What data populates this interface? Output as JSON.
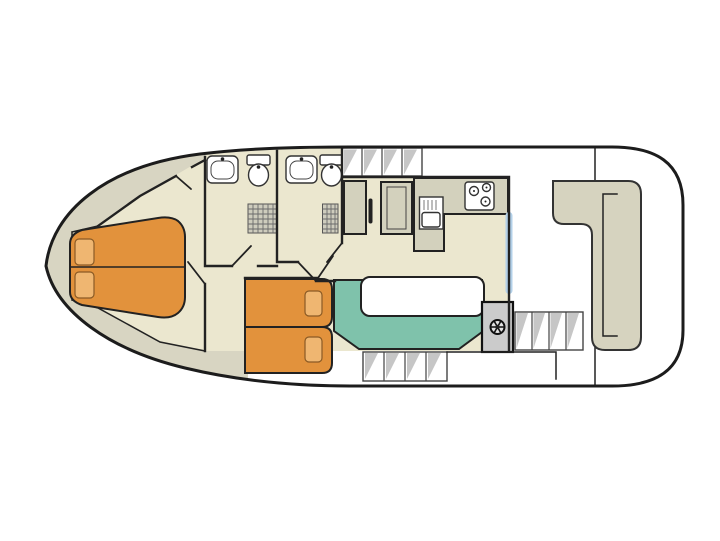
{
  "diagram": {
    "kind": "houseboat-deck-plan",
    "rooms": [
      {
        "name": "foredeck"
      },
      {
        "name": "bow-cabin"
      },
      {
        "name": "corridor"
      },
      {
        "name": "bathroom-forward"
      },
      {
        "name": "bathroom-aft"
      },
      {
        "name": "galley"
      },
      {
        "name": "salon"
      },
      {
        "name": "aft-cabin"
      },
      {
        "name": "helm-station"
      },
      {
        "name": "aft-deck"
      }
    ],
    "furniture": [
      {
        "name": "double-bed-bow",
        "pillows": 2
      },
      {
        "name": "single-bed-upper",
        "pillows": 1
      },
      {
        "name": "single-bed-lower",
        "pillows": 1
      },
      {
        "name": "dinette-bench"
      },
      {
        "name": "dinette-table"
      },
      {
        "name": "stern-l-bench"
      },
      {
        "name": "fridge"
      },
      {
        "name": "oven-cabinet"
      },
      {
        "name": "galley-counter"
      },
      {
        "name": "gas-stove",
        "burners": 3
      },
      {
        "name": "galley-sink"
      },
      {
        "name": "washbasin",
        "count": 2
      },
      {
        "name": "toilet",
        "count": 2
      },
      {
        "name": "shower",
        "count": 2
      },
      {
        "name": "steering-wheel"
      },
      {
        "name": "side-deck-steps",
        "count": 2
      },
      {
        "name": "aft-deck-steps",
        "count": 1
      },
      {
        "name": "sliding-glass-door"
      }
    ],
    "colors": {
      "hull_outline": "#1c1c1c",
      "wall": "#222222",
      "deck": "#d8d5c2",
      "floor": "#ebe7cf",
      "counter": "#d3d1bd",
      "bench": "#d6d3bf",
      "bed": "#e2923c",
      "pillow": "#efb671",
      "dinette": "#7fc2ab",
      "helm": "#cbcbcb",
      "glass": "#b3d0e8",
      "step_shade": "#c6c6c6"
    }
  }
}
